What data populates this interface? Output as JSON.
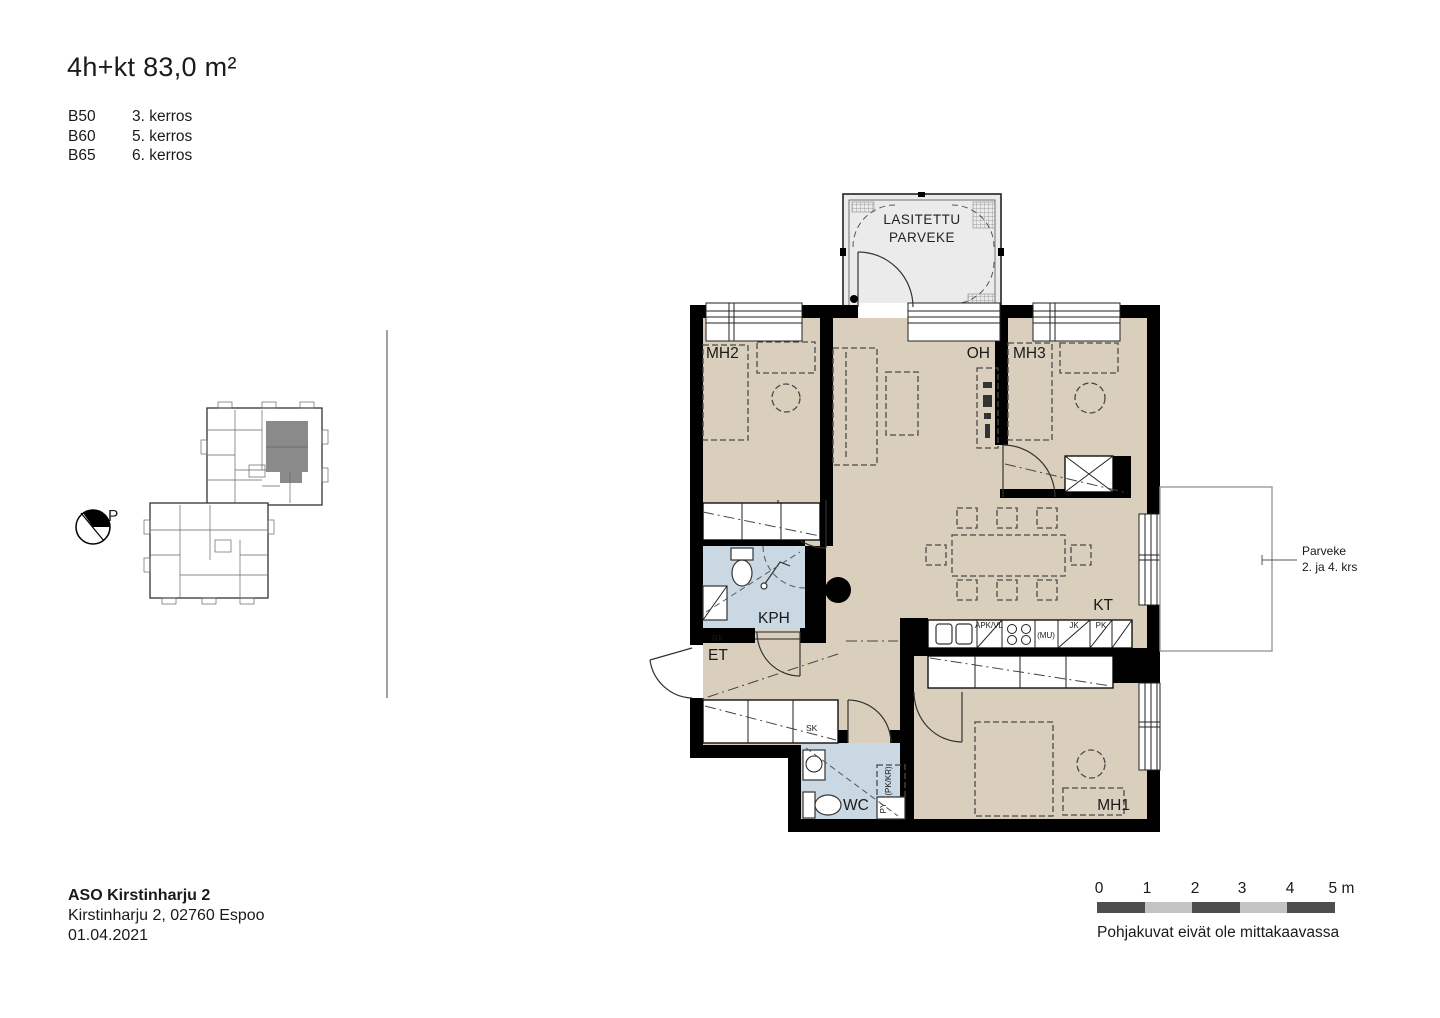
{
  "header": {
    "title": "4h+kt 83,0 m²",
    "units": [
      {
        "code": "B50",
        "floor": "3. kerros"
      },
      {
        "code": "B60",
        "floor": "5. kerros"
      },
      {
        "code": "B65",
        "floor": "6. kerros"
      }
    ]
  },
  "key_plan": {
    "compass_label": "P",
    "highlight_color": "#8a8a8a"
  },
  "plan": {
    "balcony": {
      "label_line1": "LASITETTU",
      "label_line2": "PARVEKE"
    },
    "rooms": {
      "mh2": "MH2",
      "oh": "OH",
      "mh3": "MH3",
      "kph": "KPH",
      "et": "ET",
      "kt": "KT",
      "wc": "WC",
      "mh1": "MH1"
    },
    "fixtures": {
      "rk": "RK",
      "sk": "SK",
      "apk": "APK/VL",
      "mu": "(MU)",
      "jk": "JK",
      "pk": "PK",
      "pk_kr": "(PK/KR)",
      "py": "PY"
    },
    "annotation": {
      "line1": "Parveke",
      "line2": "2. ja 4. krs"
    },
    "colors": {
      "floor": "#d9cfbc",
      "wet_room": "#c9d8e3",
      "balcony": "#ebebeb",
      "wall": "#000000"
    }
  },
  "footer": {
    "project": "ASO Kirstinharju 2",
    "address": "Kirstinharju 2, 02760 Espoo",
    "date": "01.04.2021"
  },
  "scalebar": {
    "ticks": [
      "0",
      "1",
      "2",
      "3",
      "4",
      "5 m"
    ],
    "caption": "Pohjakuvat eivät ole mittakaavassa",
    "dark": "#4d4d4d",
    "light": "#c3c3c3"
  }
}
